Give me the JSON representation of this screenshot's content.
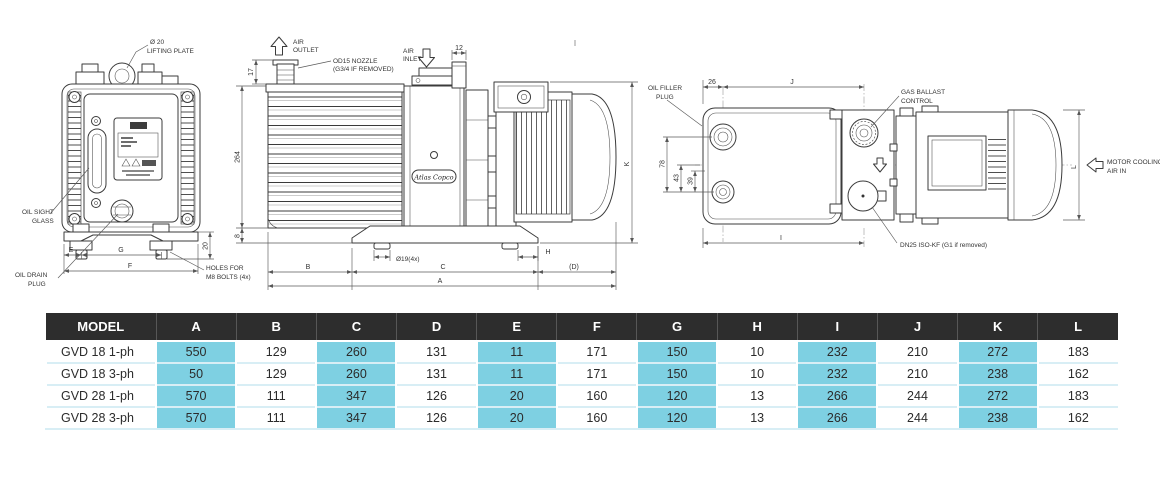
{
  "drawings": {
    "front": {
      "lifting_hole": "Ø 20",
      "lifting_plate": "LIFTING PLATE",
      "oil_sight_1": "OIL SIGHT",
      "oil_sight_2": "GLASS",
      "oil_drain_1": "OIL DRAIN",
      "oil_drain_2": "PLUG",
      "holes_1": "HOLES FOR",
      "holes_2": "M8 BOLTS (4x)",
      "dim_e": "E",
      "dim_g": "G",
      "dim_f": "F",
      "dim_foot": "20"
    },
    "side": {
      "air_outlet_1": "AIR",
      "air_outlet_2": "OUTLET",
      "nozzle_1": "OD15 NOZZLE",
      "nozzle_2": "(G3/4 IF REMOVED)",
      "air_inlet_1": "AIR",
      "air_inlet_2": "INLET",
      "brand": "Atlas Copco",
      "dim_12": "12",
      "dim_17": "17",
      "dim_264": "264",
      "dim_8": "8",
      "foot_hole": "Ø19(4x)",
      "dim_b": "B",
      "dim_c": "C",
      "dim_d": "(D)",
      "dim_a": "A",
      "dim_h": "H",
      "dim_k": "K"
    },
    "top": {
      "oil_filler_1": "OIL FILLER",
      "oil_filler_2": "PLUG",
      "gas_ballast_1": "GAS BALLAST",
      "gas_ballast_2": "CONTROL",
      "dn25": "DN25 ISO-KF (G1 if removed)",
      "motor_cooling_1": "MOTOR COOLING",
      "motor_cooling_2": "AIR IN",
      "dim_26": "26",
      "dim_j": "J",
      "dim_78": "78",
      "dim_43": "43",
      "dim_39": "39",
      "dim_i": "I",
      "dim_l": "L"
    }
  },
  "table": {
    "columns": [
      "MODEL",
      "A",
      "B",
      "C",
      "D",
      "E",
      "F",
      "G",
      "H",
      "I",
      "J",
      "K",
      "L"
    ],
    "highlight_columns": [
      "A",
      "C",
      "E",
      "G",
      "I",
      "K"
    ],
    "rows": [
      {
        "model": "GVD 18 1-ph",
        "values": [
          "550",
          "129",
          "260",
          "131",
          "11",
          "171",
          "150",
          "10",
          "232",
          "210",
          "272",
          "183"
        ]
      },
      {
        "model": "GVD 18 3-ph",
        "values": [
          "50",
          "129",
          "260",
          "131",
          "11",
          "171",
          "150",
          "10",
          "232",
          "210",
          "238",
          "162"
        ]
      },
      {
        "model": "GVD 28 1-ph",
        "values": [
          "570",
          "111",
          "347",
          "126",
          "20",
          "160",
          "120",
          "13",
          "266",
          "244",
          "272",
          "183"
        ]
      },
      {
        "model": "GVD 28 3-ph",
        "values": [
          "570",
          "111",
          "347",
          "126",
          "20",
          "160",
          "120",
          "13",
          "266",
          "244",
          "238",
          "162"
        ]
      }
    ],
    "colors": {
      "header_bg": "#2d2d2d",
      "header_fg": "#ffffff",
      "highlight": "#7ed0e2",
      "separator": "#d8eef5"
    }
  }
}
